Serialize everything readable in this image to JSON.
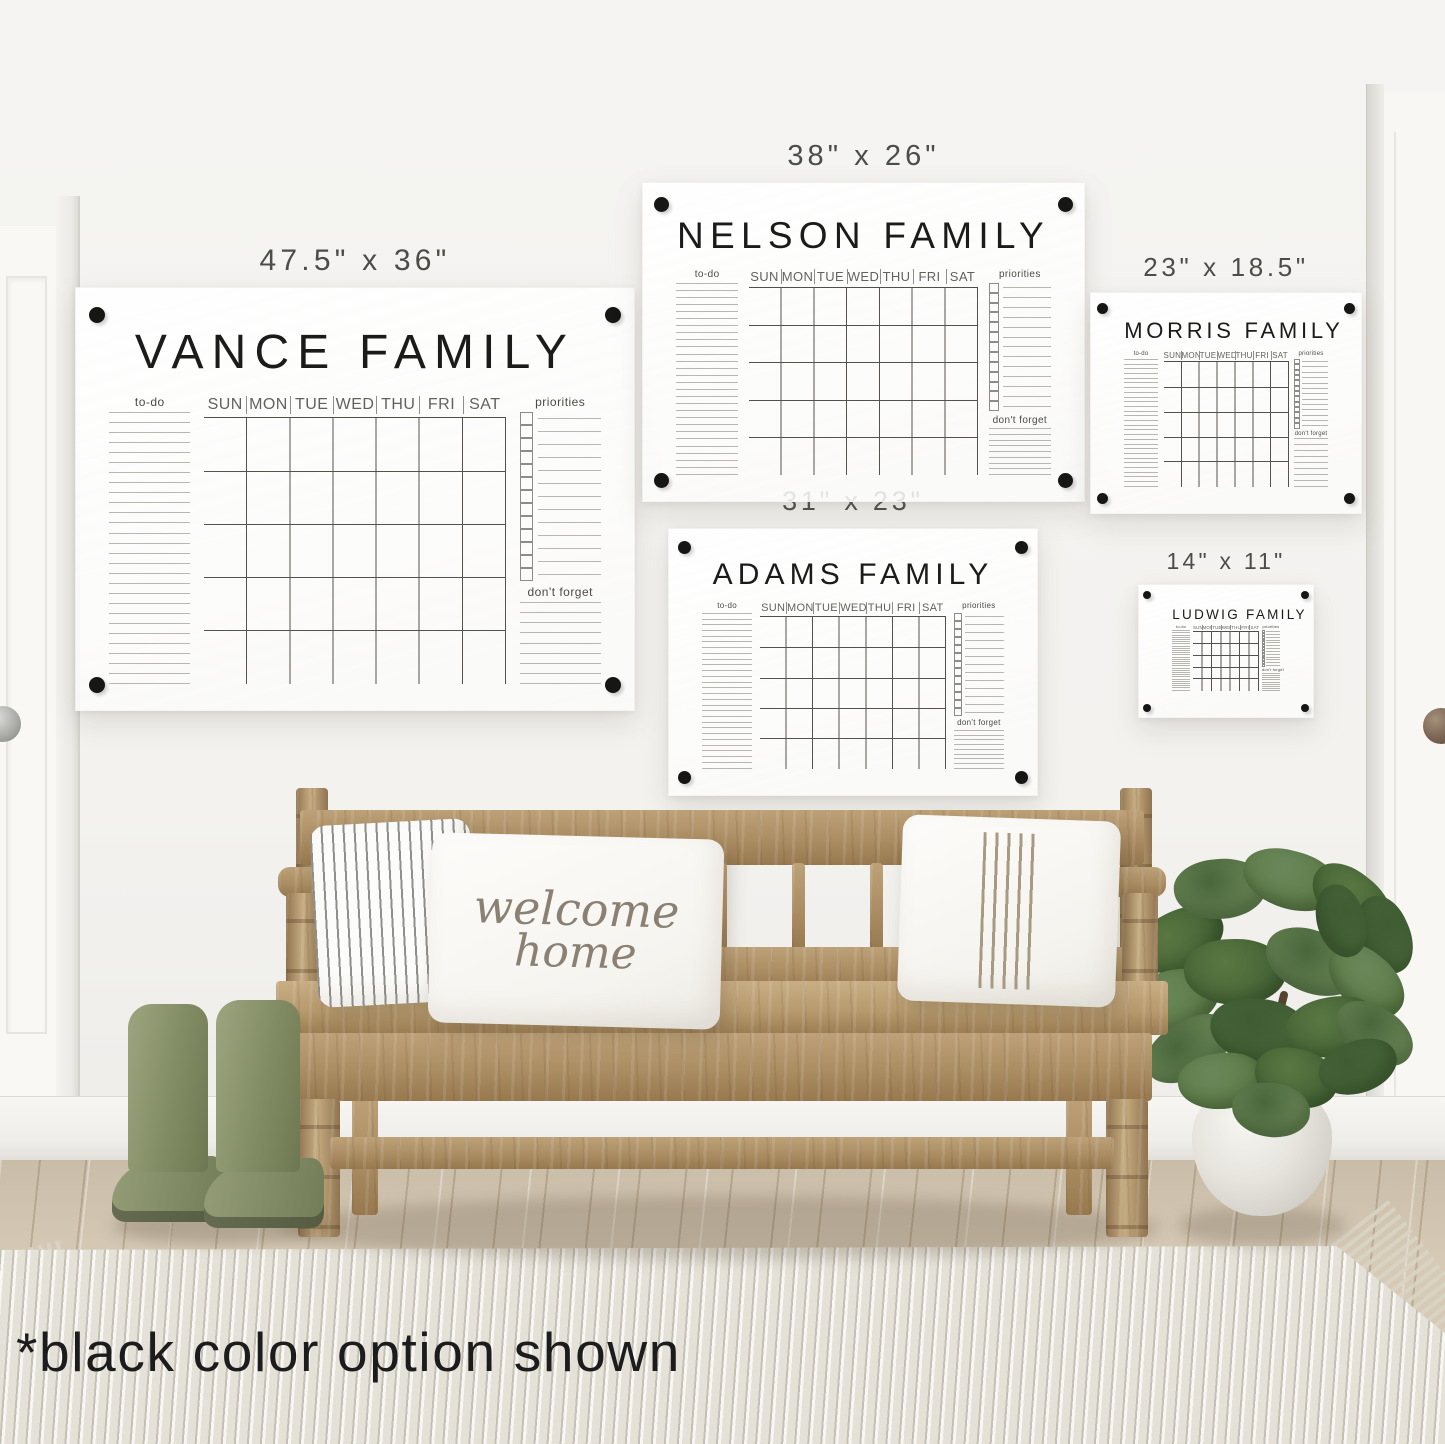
{
  "caption": "*black color option shown",
  "pillow": {
    "line1": "welcome",
    "line2": "home"
  },
  "calendar_labels": {
    "todo": "to-do",
    "priorities": "priorities",
    "dont_forget": "don't forget"
  },
  "days": [
    "SUN",
    "MON",
    "TUE",
    "WED",
    "THU",
    "FRI",
    "SAT"
  ],
  "calendars": [
    {
      "id": "vance",
      "title": "VANCE FAMILY",
      "size_label": "47.5\" x 36\""
    },
    {
      "id": "nelson",
      "title": "NELSON FAMILY",
      "size_label": "38\" x 26\""
    },
    {
      "id": "morris",
      "title": "MORRIS FAMILY",
      "size_label": "23\" x 18.5\""
    },
    {
      "id": "adams",
      "title": "ADAMS FAMILY",
      "size_label": "31\" x 23\""
    },
    {
      "id": "ludwig",
      "title": "LUDWIG FAMILY",
      "size_label": "14\" x 11\""
    }
  ],
  "colors": {
    "calendar_text": "#1b1b19",
    "size_label_text": "#4c4c48",
    "mount_dot": "#161614",
    "wall": "#f4f3f1",
    "floor_wood": "#d6cab6",
    "rug": "#edeae3",
    "bench_wood": "#ab8d63",
    "boots_green": "#828c64",
    "plant_green": "#587741",
    "pillow_script_text": "#8a8073"
  }
}
